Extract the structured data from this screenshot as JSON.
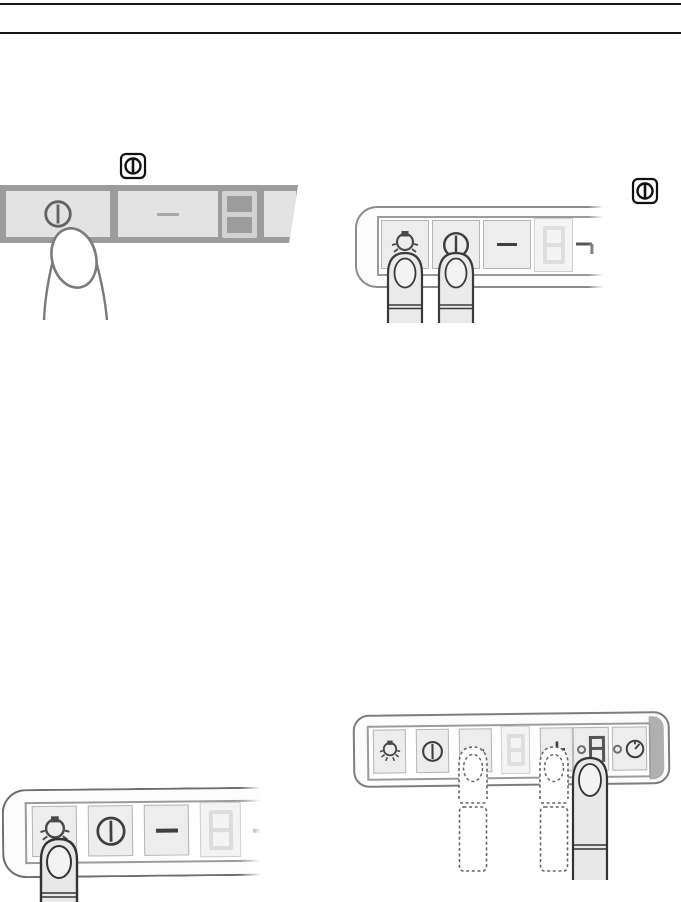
{
  "page": {
    "type": "appliance-manual-illustration-page",
    "background": "#ffffff",
    "rule_color": "#161616",
    "accent_dark": "#3a3a3a",
    "panel_dark_gray": "#9c9c9c",
    "panel_body_white": "#fcfcfc",
    "key_gray": "#ededed"
  },
  "badges": {
    "power_symbol": {
      "icon": "power-symbol-icon",
      "meaning": "on/off key symbol"
    }
  },
  "illustrations": {
    "top_left": {
      "name": "press-power-key-dark-panel",
      "badge": "power-symbol",
      "display_value": "8",
      "finger_style": "outline",
      "buttons": [
        {
          "label": "power-key",
          "icon": "power-icon",
          "pressed": true
        },
        {
          "label": "level-key",
          "icon": "dash-icon",
          "pressed": false
        },
        {
          "label": "display",
          "value": "8"
        },
        {
          "label": "partial-key",
          "icon": "none"
        }
      ]
    },
    "top_right": {
      "name": "press-light-and-power-keys",
      "badge": "power-symbol",
      "display_value": "8",
      "finger_style": "solid",
      "buttons": [
        {
          "label": "light-key",
          "icon": "light-icon",
          "pressed": true
        },
        {
          "label": "power-key",
          "icon": "power-icon",
          "pressed": true
        },
        {
          "label": "minus-key",
          "icon": "minus-icon",
          "pressed": false
        },
        {
          "label": "display",
          "value": "8"
        },
        {
          "label": "plus-key-partial",
          "icon": "plus-partial-icon",
          "pressed": false
        }
      ]
    },
    "bottom_right": {
      "name": "full-panel-minus-plus-auto",
      "display_value": "8",
      "mode_value": "A",
      "buttons": [
        {
          "label": "light-key",
          "icon": "light-icon",
          "pressed": false
        },
        {
          "label": "power-key",
          "icon": "power-icon",
          "pressed": false
        },
        {
          "label": "minus-key",
          "icon": "minus-icon",
          "pressed": true,
          "finger": "dashed"
        },
        {
          "label": "display",
          "value": "8"
        },
        {
          "label": "plus-key",
          "icon": "plus-icon",
          "pressed": true,
          "finger": "dashed"
        },
        {
          "label": "auto-key",
          "icon": "seven-segment-A",
          "led": true,
          "pressed": true,
          "finger": "solid"
        },
        {
          "label": "timer-key",
          "icon": "clock-icon",
          "led": true,
          "pressed": false
        }
      ]
    },
    "bottom_left": {
      "name": "press-light-key",
      "display_value": "8",
      "finger_style": "solid",
      "buttons": [
        {
          "label": "light-key",
          "icon": "light-icon",
          "pressed": true
        },
        {
          "label": "power-key",
          "icon": "power-icon",
          "pressed": false
        },
        {
          "label": "minus-key",
          "icon": "minus-icon",
          "pressed": false
        },
        {
          "label": "display",
          "value": "8"
        },
        {
          "label": "minus-key-partial",
          "icon": "dash-icon",
          "pressed": false
        }
      ]
    }
  }
}
